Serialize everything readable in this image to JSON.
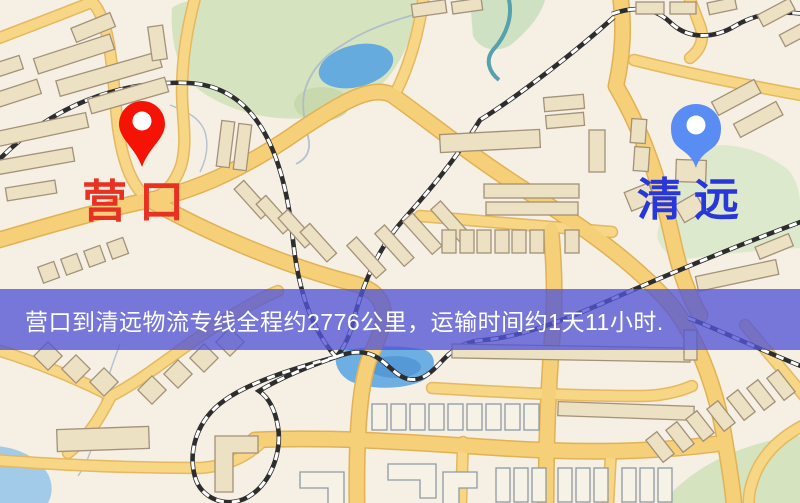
{
  "banner": {
    "text": "营口到清远物流专线全程约2776公里，运输时间约1天11小时.",
    "background_color": "#5255d6",
    "text_color": "#ffffff"
  },
  "route": {
    "origin": "营口",
    "destination": "清远",
    "distance_text": "约2776公里",
    "duration_text": "约1天11小时"
  },
  "markers": {
    "origin": {
      "label": "营口",
      "pin_color": "#ed1506",
      "label_color": "#e93122"
    },
    "destination": {
      "label": "清远",
      "pin_color": "#5c8df0",
      "label_color": "#2737d9"
    }
  },
  "map_colors": {
    "background": "#f5efe4",
    "road_fill": "#f5d07c",
    "road_edge": "#dfb258",
    "park_green": "#d5e3c0",
    "water_blue": "#6fafe0",
    "building_tan": "#ece1c3",
    "railway_dark": "#2d2d2d"
  }
}
